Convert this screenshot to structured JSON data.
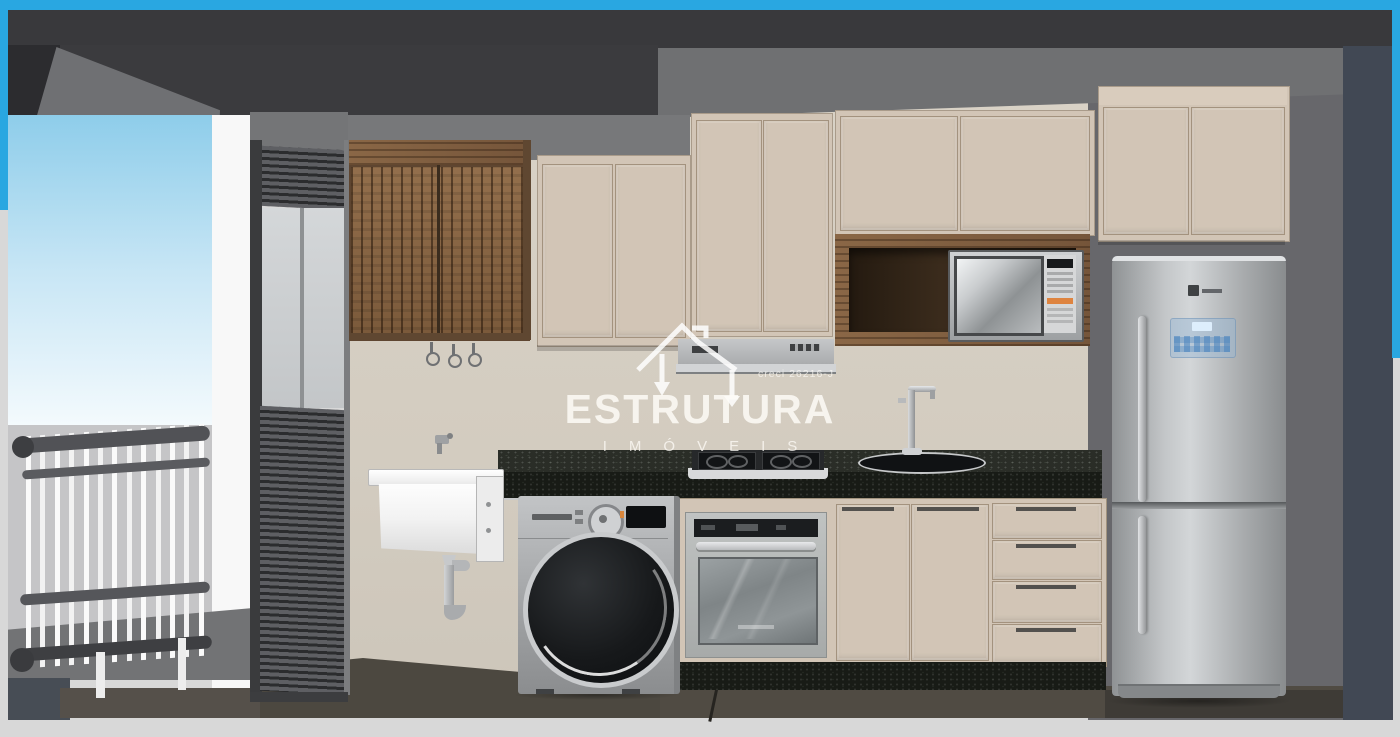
{
  "watermark": {
    "brand": "ESTRUTURA",
    "subtitle": "IMÓVEIS",
    "license": "creci 26216-J"
  },
  "palette": {
    "frame_blue": "#29a7e1",
    "wall_cream": "#d7d0c4",
    "cabinet_beige": "#d2c5b6",
    "wood": "#84613f",
    "granite": "#20231d",
    "floor": "#4f4a42",
    "sky_top": "#8ecdea",
    "ceiling_dark": "#3b3b3e",
    "wall_right_gray": "#67676b",
    "wall_far_slate": "#414854",
    "stainless": "#b8bbbd"
  },
  "scene": {
    "objects": [
      "ceiling-beam",
      "balcony-railing",
      "window-roller-shutter",
      "slatted-wood-wall-cabinet",
      "wall-tap",
      "laundry-tub",
      "drain-pipe",
      "washing-machine",
      "range-hood",
      "cooktop",
      "built-in-oven",
      "granite-countertop",
      "kitchen-sink",
      "faucet",
      "microwave",
      "wood-niche",
      "upper-cabinets",
      "base-cabinets",
      "drawer-stack",
      "refrigerator",
      "overhead-fridge-cabinet"
    ]
  }
}
